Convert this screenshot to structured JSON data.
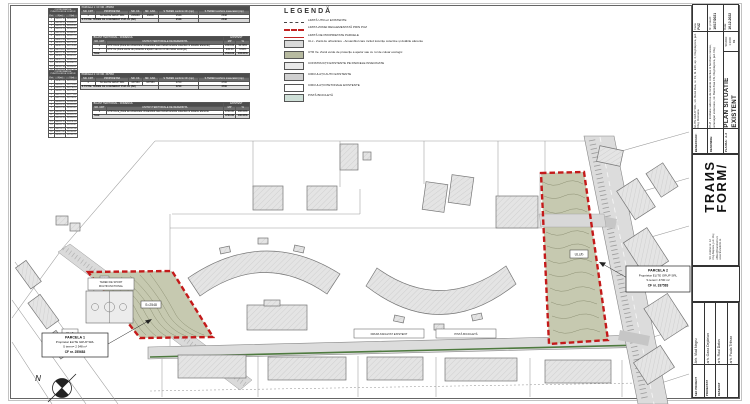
{
  "tables": {
    "coords1": {
      "title": "COORDONATELE PUNCTELOR DE CONTUR",
      "headers": [
        "Pct.",
        "X [m]",
        "Y [m]"
      ],
      "rows": [
        [
          "1",
          "586241.18",
          "392610.44"
        ],
        [
          "2",
          "586238.52",
          "392628.11"
        ],
        [
          "3",
          "586231.76",
          "392645.89"
        ],
        [
          "4",
          "586224.31",
          "392663.05"
        ],
        [
          "5",
          "586216.90",
          "392680.42"
        ],
        [
          "6",
          "586209.44",
          "392697.78"
        ],
        [
          "7",
          "586201.98",
          "392715.15"
        ],
        [
          "8",
          "586194.53",
          "392732.51"
        ],
        [
          "9",
          "586187.07",
          "392749.88"
        ],
        [
          "10",
          "586179.62",
          "392767.24"
        ],
        [
          "11",
          "586172.16",
          "392784.61"
        ],
        [
          "12",
          "586164.71",
          "392801.97"
        ],
        [
          "13",
          "586157.25",
          "392819.34"
        ],
        [
          "14",
          "586149.80",
          "392836.70"
        ],
        [
          "15",
          "586142.34",
          "392854.07"
        ],
        [
          "16",
          "586134.89",
          "392871.43"
        ],
        [
          "17",
          "586127.43",
          "392888.80"
        ]
      ]
    },
    "coords2": {
      "title": "COORDONATELE PUNCTELOR DE CONTUR",
      "headers": [
        "Pct.",
        "X [m]",
        "Y [m]"
      ],
      "rows": [
        [
          "1",
          "586302.44",
          "392701.12"
        ],
        [
          "2",
          "586298.91",
          "392718.63"
        ],
        [
          "3",
          "586292.35",
          "392736.20"
        ],
        [
          "4",
          "586285.78",
          "392753.77"
        ],
        [
          "5",
          "586279.22",
          "392771.34"
        ],
        [
          "6",
          "586272.65",
          "392788.91"
        ],
        [
          "7",
          "586266.09",
          "392806.48"
        ],
        [
          "8",
          "586259.52",
          "392824.05"
        ],
        [
          "9",
          "586252.96",
          "392841.62"
        ],
        [
          "10",
          "586246.39",
          "392859.19"
        ],
        [
          "11",
          "586239.83",
          "392876.76"
        ],
        [
          "12",
          "586233.26",
          "392894.33"
        ],
        [
          "13",
          "586226.70",
          "392911.90"
        ],
        [
          "14",
          "586220.13",
          "392929.47"
        ],
        [
          "15",
          "586213.57",
          "392947.04"
        ],
        [
          "16",
          "586207.00",
          "392964.61"
        ],
        [
          "17",
          "586200.44",
          "392982.18"
        ]
      ]
    },
    "parcela1": {
      "title": "PARCELA 1:  CF NR. 255683",
      "headers": [
        "NR. CRT",
        "PROPRIETAR",
        "NR. CF.",
        "NR. CAD.",
        "S TEREN conform CF (mp)",
        "S TEREN conform masuratori (mp)"
      ],
      "rows": [
        [
          "1",
          "SC ELITE GRUP SRL",
          "255683",
          "26800",
          "2548",
          "2548"
        ]
      ],
      "total_label": "S TOTAL TEREN CE A GENERAT PUZ-UL (B2)",
      "total_v1": "2548",
      "total_v2": "2548"
    },
    "bilant1": {
      "title": "BILANT TERITORIAL - DOMENIUL",
      "title2": "EXISTENT",
      "headers": [
        "NR. CRT",
        "UNITATI TERITORIALE DE REFERINTA",
        "MP",
        "%"
      ],
      "rows": [
        [
          "1",
          "UTR ULca (Zona de urbanizare. Ansamblul care includ locuinte colective si dotarile aferente)",
          "2303.00",
          "90.38%"
        ],
        [
          "1",
          "UTR Ve (Zona verde de protectie a apelor sau cu rol de culoar ecologic)",
          "245.00",
          "9.62%"
        ]
      ],
      "total_label": "Total",
      "total_v1": "2548.00",
      "total_v2": "100.00%"
    },
    "parcela2": {
      "title": "PARCELA 2:  CF NR. 337583",
      "headers": [
        "NR. CRT",
        "PROPRIETAR",
        "NR. CF.",
        "NR. CAD.",
        "S TEREN conform CF (mp)",
        "S TEREN conform masuratori (mp)"
      ],
      "rows": [
        [
          "1",
          "SC ELITE GRUP SRL",
          "337583",
          "337583",
          "4700",
          "4700"
        ]
      ],
      "total_label": "S TOTAL TEREN CE A GENERAT PUZ-UL (B2)",
      "total_v1": "4700",
      "total_v2": "4700"
    },
    "bilant2": {
      "title": "BILANT TERITORIAL - DOMENIUL",
      "title2": "EXISTENT",
      "headers": [
        "NR. CRT",
        "UNITATI TERITORIALE DE REFERINTA",
        "MP",
        "%"
      ],
      "rows": [
        [
          "1",
          "UTR ULca_Zona de urbanizare. Ansamblul care includ locuinte colective si dotarile aferente",
          "4700.00",
          "100.00%"
        ]
      ],
      "total_label": "Total",
      "total_v1": "4700.00",
      "total_v2": "100.00%"
    }
  },
  "legend": {
    "title": "LEGENDĂ",
    "items": [
      {
        "name": "utr-limit-line",
        "type": "ln line-dash",
        "label": "LIMITĂ UTR-uri EXISTENTE"
      },
      {
        "name": "puz-zone-limit-line",
        "type": "ln line-red-thick",
        "label": "LIMITA ZONEI REGLEMENTATĂ PRIN PUZ"
      },
      {
        "name": "property-limit-line",
        "type": "ln line-red-thin",
        "label": "LIMITĂ DE PROPRIETATE PARCELE"
      },
      {
        "name": "ulc-zone-swatch",
        "type": "sw-gray",
        "label": "ULc - Zonă de urbanizare - Ansamblul care includ locuințe colective și dotările aferente"
      },
      {
        "name": "utr-ve-swatch",
        "type": "sw-olive",
        "label": "UTR Ve. Zonă verde de protecție a apelor sau cu rol de culoar ecologic"
      },
      {
        "name": "existing-buildings-swatch",
        "type": "sw-light",
        "label": "CONSTRUCȚII EXISTENTE PE PARCELE INVECINATE"
      },
      {
        "name": "auto-circulation-swatch",
        "type": "sw-mid",
        "label": "CIRCULAȚII AUTO EXISTENTE"
      },
      {
        "name": "pedestrian-circulation-swatch",
        "type": "sw-white",
        "label": "CIRCULAȚII PIETONALE EXISTENTE"
      },
      {
        "name": "bike-lane-swatch",
        "type": "sw-teal",
        "label": "PISTĂ BICICLETĂ"
      }
    ]
  },
  "map": {
    "p1": {
      "l1": "PARCELA 1",
      "l2": "Proprietar ELITE GRUP SRL",
      "l3": "S teren= 2 548 m²",
      "l4": "CF nr. 255683"
    },
    "p2": {
      "l1": "PARCELA 2",
      "l2": "Proprietar ELITE GRUP SRL",
      "l3": "S teren= 4700 m²",
      "l4": "CF nr. 337583"
    },
    "court1": "TEREN DE SPORT",
    "court2": "MULTIFUNCTIONAL",
    "street1": "DRUM ASFALTAT EXISTENT",
    "street2": "PISTĂ BICICLETĂ",
    "zone_p1": "S=2548",
    "zone_tag1": "ULc/b",
    "zone_tag2": "ULc/b",
    "north": "N"
  },
  "titleblock": {
    "beneficiar_label": "BENEFICIAR:",
    "beneficiar": "ELITE GRUP SRL, str. Bună Ziua, nr. 19, bl. E19, ap. 4, Cluj-Napoca, jud. Cluj, Romania",
    "denumire_label": "DENUMIRE:",
    "denumire": "PUZ - Instituire subzona de locuinte colective si functiuni conexe, amenajari exterioare, str. Bună Ziua FN, Cluj-Napoca, jud. Cluj",
    "plansa_label": "PLANSA:",
    "plansa_nr": "A-3",
    "plan_title": "PLAN SITUATIE EXISTENT",
    "faza_label": "Faza:",
    "faza": "PUZ",
    "proiect_label": "Nr. proiect:",
    "proiect": "16/17/2021",
    "data_label": "Data:",
    "data": "16.12.2022",
    "scara_label": "SCARA:",
    "scara": "1:1000",
    "rev": "01",
    "logo1": "TRAИS",
    "logo2": "FORM/",
    "addr1": "Str. Colinei nr. 12",
    "addr2": "Cluj-Napoca, jud. Cluj",
    "addr3": "office@transform.ro",
    "addr4": "www.transform.ro",
    "sef_label": "SEF PROIECT",
    "sef": "Arh. Vlad Negru",
    "proiectat_label": "PROIECTAT",
    "proiectat": "arh. Oana Dejdeian",
    "desenat_label": "DESENAT",
    "desenat": "arh. Raul Datos",
    "desenat2_label": "",
    "desenat2": "arh. Paula Trifean"
  }
}
